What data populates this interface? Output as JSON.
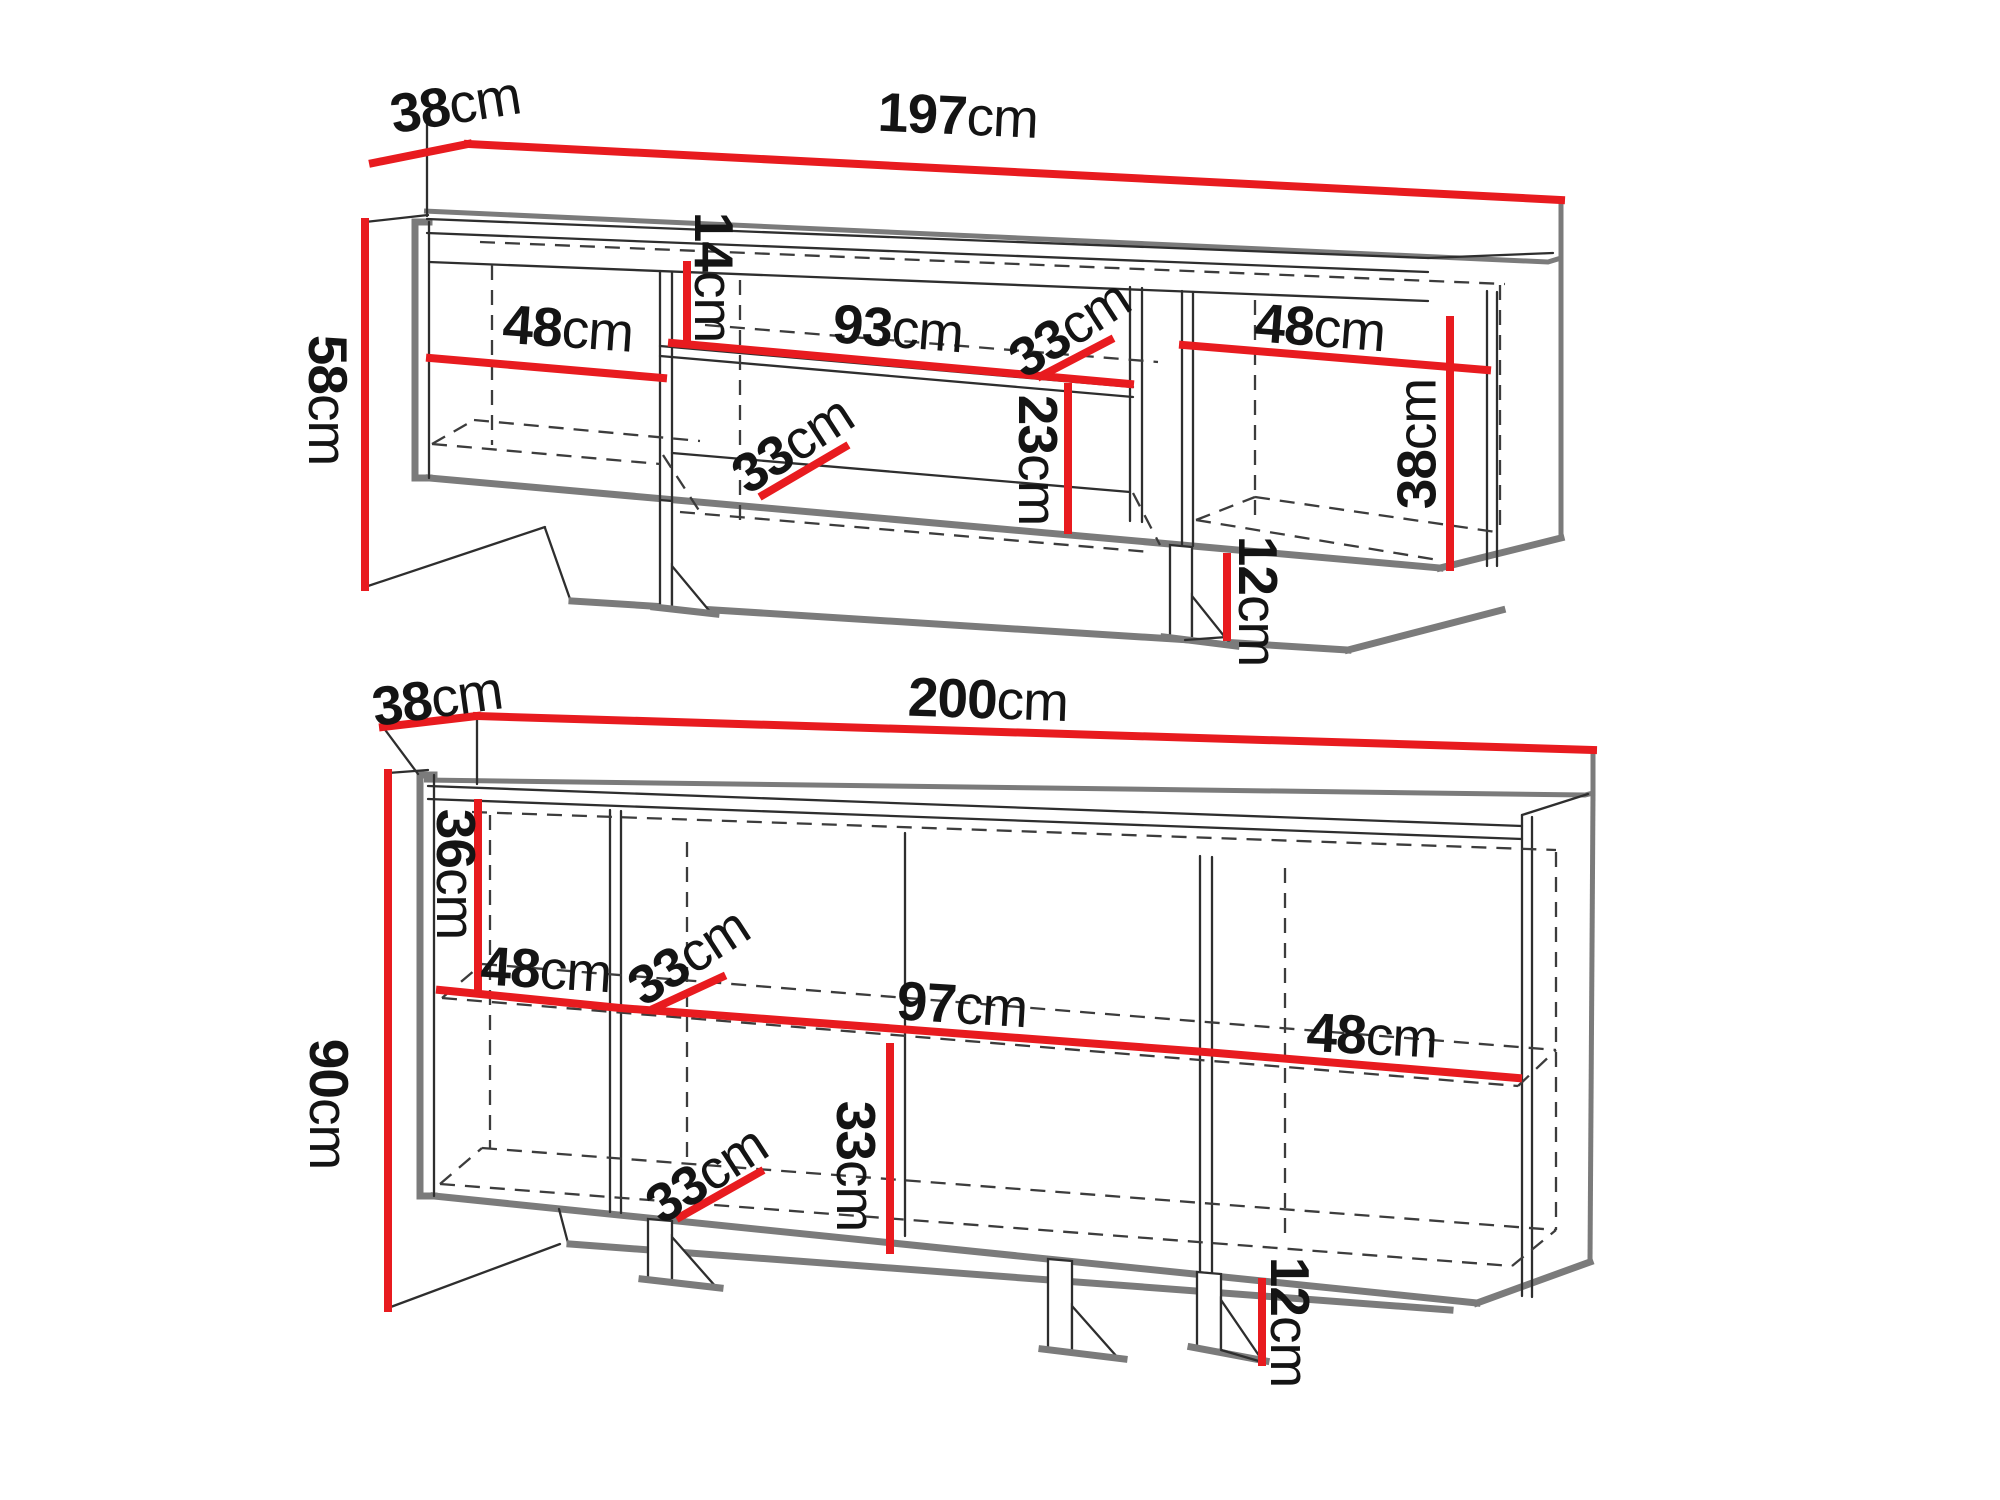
{
  "colors": {
    "dimension_red": "#e81b1f",
    "outline_gray": "#7b7b7b",
    "line_dark": "#2e2e2e",
    "text": "#141414",
    "background": "#ffffff"
  },
  "tv_stand": {
    "width": {
      "value": "197",
      "unit": "cm"
    },
    "depth": {
      "value": "38",
      "unit": "cm"
    },
    "height": {
      "value": "58",
      "unit": "cm"
    },
    "left_door_width": {
      "value": "48",
      "unit": "cm"
    },
    "niche_height": {
      "value": "14",
      "unit": "cm"
    },
    "niche_width": {
      "value": "93",
      "unit": "cm"
    },
    "niche_depth": {
      "value": "33",
      "unit": "cm"
    },
    "bottom_shelf_depth": {
      "value": "33",
      "unit": "cm"
    },
    "drawer_height": {
      "value": "23",
      "unit": "cm"
    },
    "right_door_width": {
      "value": "48",
      "unit": "cm"
    },
    "right_inner_height": {
      "value": "38",
      "unit": "cm"
    },
    "foot_height": {
      "value": "12",
      "unit": "cm"
    }
  },
  "sideboard": {
    "width": {
      "value": "200",
      "unit": "cm"
    },
    "depth": {
      "value": "38",
      "unit": "cm"
    },
    "height": {
      "value": "90",
      "unit": "cm"
    },
    "top_inner_height": {
      "value": "36",
      "unit": "cm"
    },
    "left_door_width": {
      "value": "48",
      "unit": "cm"
    },
    "shelf_depth_upper": {
      "value": "33",
      "unit": "cm"
    },
    "middle_section_width": {
      "value": "97",
      "unit": "cm"
    },
    "right_door_width": {
      "value": "48",
      "unit": "cm"
    },
    "lower_inner_height": {
      "value": "33",
      "unit": "cm"
    },
    "bottom_shelf_depth": {
      "value": "33",
      "unit": "cm"
    },
    "foot_height": {
      "value": "12",
      "unit": "cm"
    }
  }
}
